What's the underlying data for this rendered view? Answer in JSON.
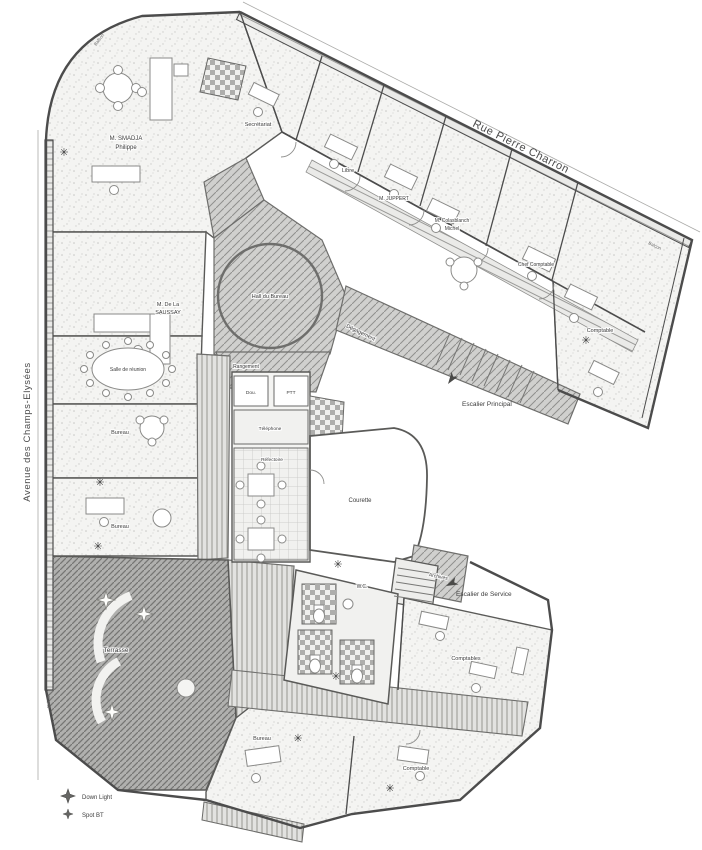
{
  "streets": {
    "top": "Rue Pierre Charron",
    "left": "Avenue des Champs-Elysées"
  },
  "labels": {
    "smadja_line1": "M. SMADJA",
    "smadja_line2": "Philippe",
    "secretariat": "Secrétariat",
    "libre": "Libre",
    "juppert": "M. JUPPERT",
    "colas_line1": "M. Colasblanch",
    "colas_line2": "Michel",
    "chef_comptable": "Chef Comptable",
    "comptable_est": "Comptable",
    "saussay_line1": "M. De La",
    "saussay_line2": "SAUSSAY",
    "salle_reunion": "Salle de réunion",
    "bureau_ouest1": "Bureau",
    "bureau_ouest2": "Bureau",
    "hall": "Hall du Bureau",
    "degagement": "Dégagement",
    "rangement": "Rangement",
    "douche": "Dou.",
    "ptt": "PTT",
    "telephone": "Téléphone",
    "refectoire": "Réfectoire",
    "courette": "Courette",
    "escalier_principal": "Escalier Principal",
    "escalier_service": "Escalier de Service",
    "archives": "Archives",
    "wc": "W.C.",
    "terrasse": "Terrasse",
    "comptables": "Comptables",
    "bureau_sud": "Bureau",
    "comptable_sud": "Comptable",
    "balcon_nord": "Balcon",
    "balcon_ouest": "Balcon",
    "balcon_est": "Balcon"
  },
  "legend": {
    "items": [
      {
        "icon": "down-light-star",
        "label": "Down Light"
      },
      {
        "icon": "spot-star",
        "label": "Spot BT"
      }
    ]
  },
  "icons": {
    "plant": "✳"
  },
  "colors": {
    "wall": "#4c4c4c",
    "circulation_hatch": "#c9c9c7",
    "terrace_hatch": "#a8a8a6",
    "office_stipple": "#f4f4f2",
    "text": "#3c3c3c"
  }
}
